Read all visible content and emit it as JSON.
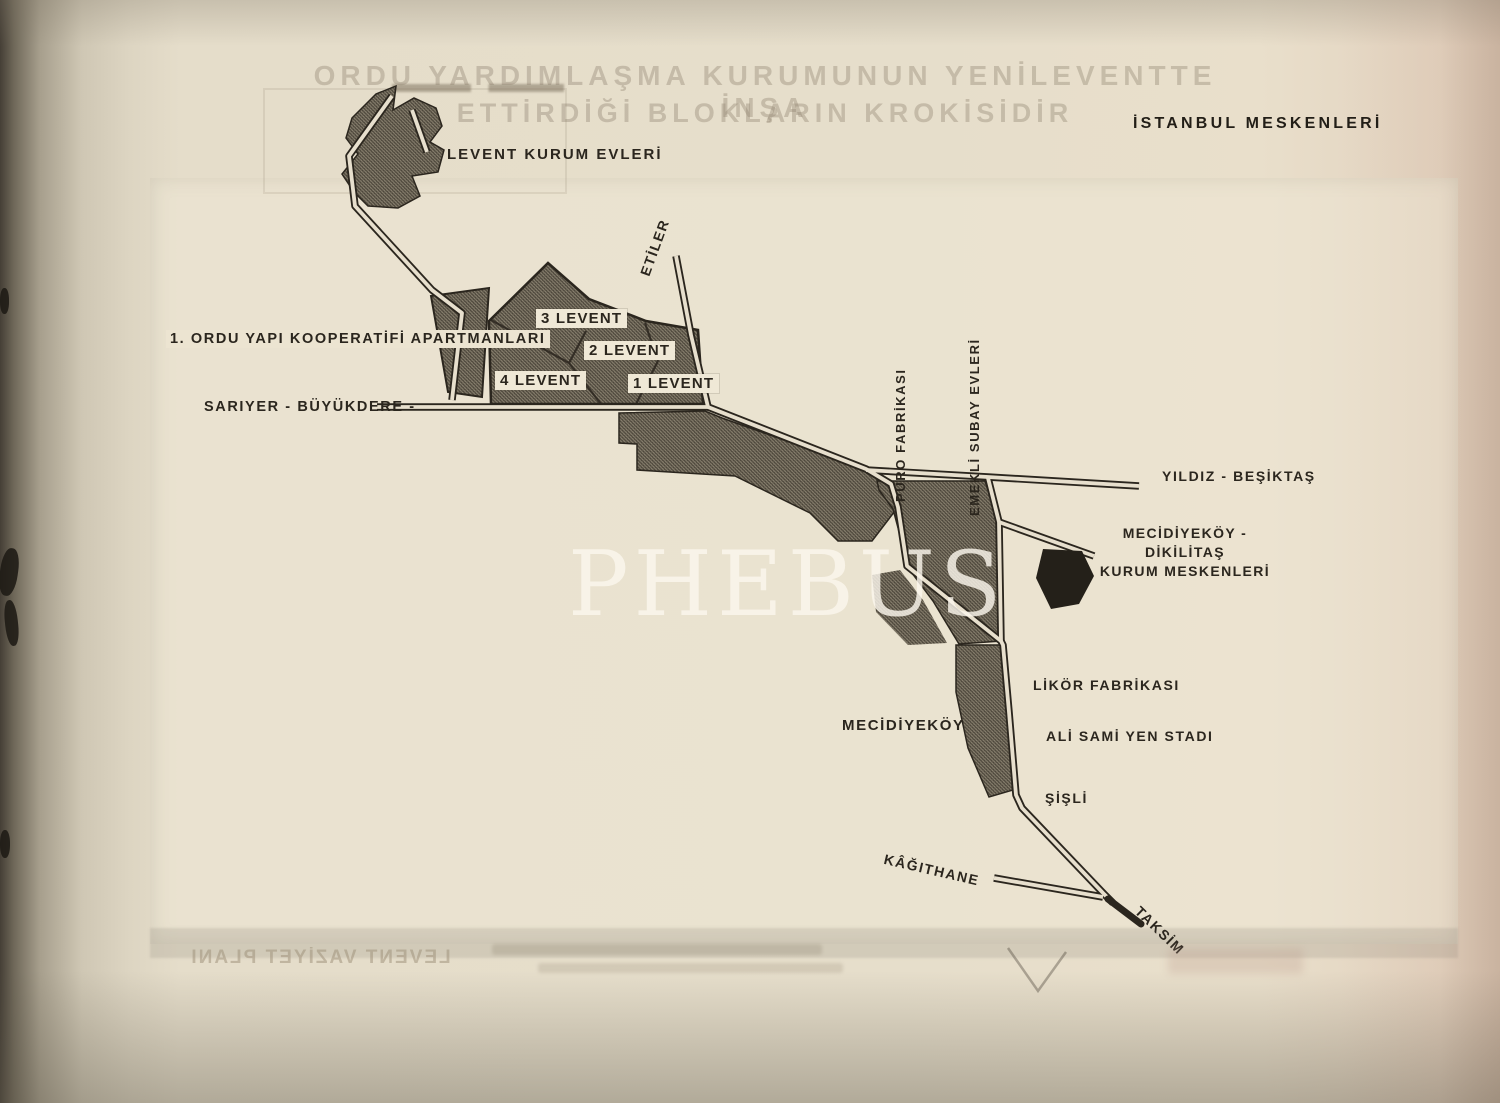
{
  "page": {
    "title": "İSTANBUL MESKENLERİ",
    "watermark": "PHEBUS",
    "ghost_header": {
      "line1": "ORDU YARDIMLAŞMA KURUMUNUN YENİLEVENTTE İNŞA",
      "line2": "ETTİRDİĞİ BLOKLARIN KROKİSİDİR"
    },
    "ghost_footer": "LEVENT VAZİYET PLANI"
  },
  "map": {
    "district_labels": {
      "levent_kurum_evleri": "LEVENT KURUM EVLERİ",
      "etiler": "ETİLER",
      "ordu_yapi_kooperatifi": "1. ORDU YAPI KOOPERATİFİ APARTMANLARI",
      "sariyer_buyukdere": "SARIYER - BÜYÜKDERE -",
      "puro_fabrikasi": "PURO FABRİKASI",
      "emekli_subay_evleri": "EMEKLİ SUBAY EVLERİ",
      "yildiz_besiktas": "YILDIZ - BEŞİKTAŞ",
      "mecidiyekoy_dikilitas_line1": "MECİDİYEKÖY - DİKİLİTAŞ",
      "mecidiyekoy_dikilitas_line2": "KURUM MESKENLERİ",
      "likor_fabrikasi": "LİKÖR FABRİKASI",
      "ali_sami_yen": "ALİ SAMİ YEN STADI",
      "mecidiyekoy": "MECİDİYEKÖY",
      "sisli": "ŞİŞLİ",
      "kagithane": "KÂĞITHANE",
      "taksim": "TAKSİM"
    },
    "parcel_labels": {
      "levent3": "3 LEVENT",
      "levent2": "2 LEVENT",
      "levent4": "4 LEVENT",
      "levent1": "1 LEVENT"
    },
    "colors": {
      "ink": "#2b261e",
      "paper": "#e6decb",
      "hatch_dark": "#4c463b",
      "solid_block": "#242019",
      "watermark_white": "#faf7ee"
    }
  }
}
